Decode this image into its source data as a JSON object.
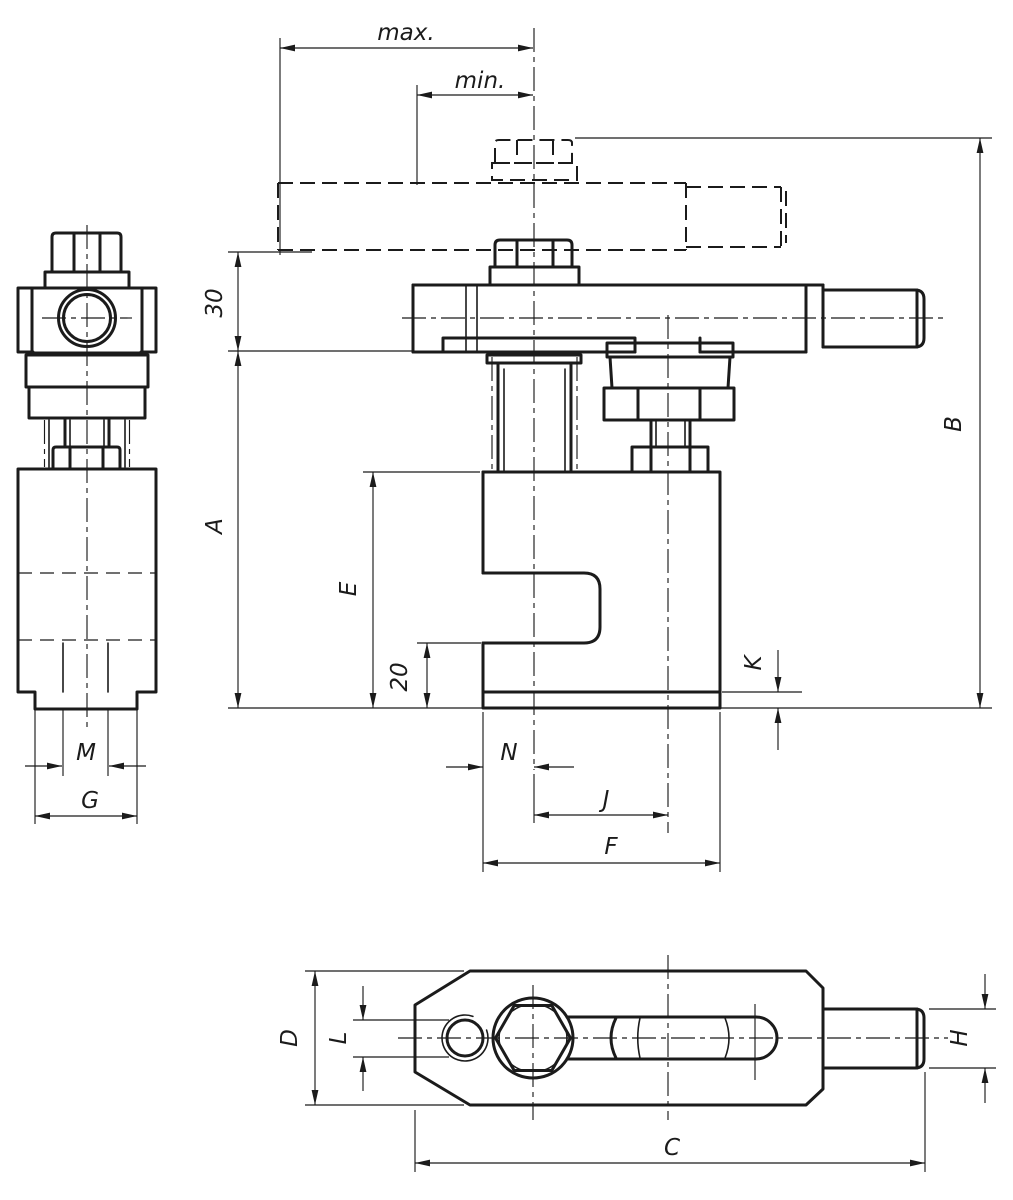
{
  "drawing": {
    "background": "#ffffff",
    "line_color": "#1b1b1b",
    "views": [
      "side-view",
      "front-view",
      "bottom-view"
    ],
    "labels": {
      "max": "max.",
      "min": "min.",
      "offset30": "30",
      "a": "A",
      "b": "B",
      "e": "E",
      "depth20": "20",
      "k": "K",
      "n": "N",
      "j": "J",
      "f": "F",
      "m": "M",
      "g": "G",
      "d": "D",
      "l": "L",
      "h": "H",
      "c": "C"
    }
  }
}
